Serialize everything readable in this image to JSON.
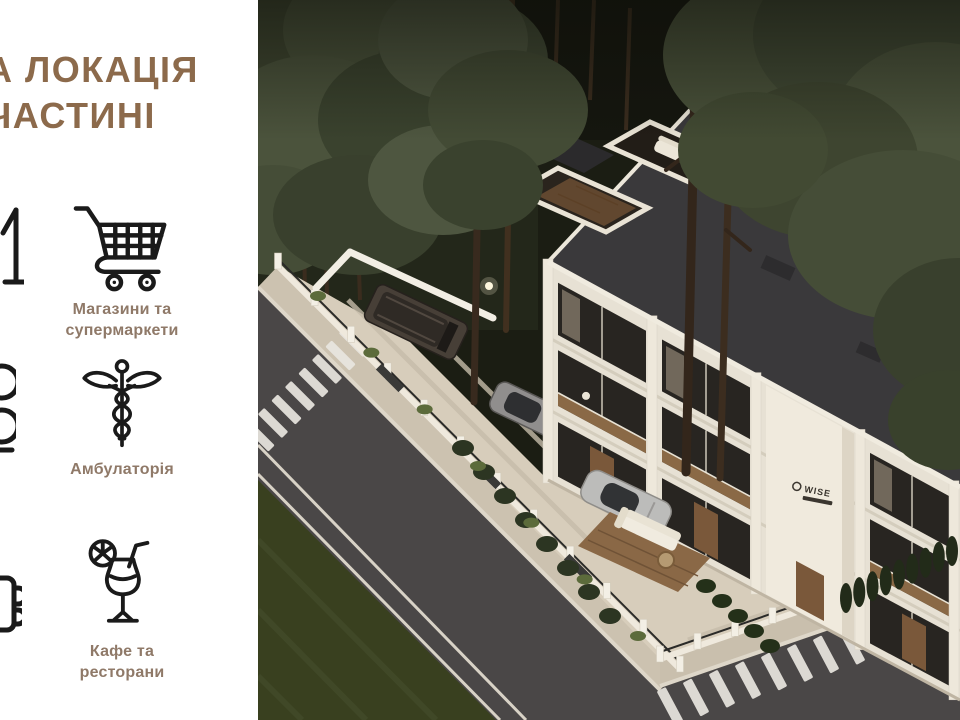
{
  "slide": {
    "title": {
      "line1": "А ЛОКАЦІЯ",
      "line2": "ЧАСТИНІ"
    },
    "features": [
      {
        "icon": "shopping-cart-icon",
        "label_line1": "Магазини та",
        "label_line2": "супермаркети"
      },
      {
        "icon": "caduceus-icon",
        "label_line1": "Амбулаторія",
        "label_line2": ""
      },
      {
        "icon": "cocktail-icon",
        "label_line1": "Кафе та",
        "label_line2": "ресторани"
      }
    ]
  },
  "render": {
    "building_logo": "WISE",
    "colors": {
      "title_brown": "#8C6A4B",
      "label_brown": "#8F7968",
      "icon_ink": "#1A1A1A",
      "roof": "#3A393B",
      "facade": "#E7E1D4",
      "road": "#4A4747",
      "sidewalk": "#CCC2B0",
      "lawn": "#39401F",
      "forest_green": "#49513A",
      "wood_deck": "#8A6946"
    }
  }
}
